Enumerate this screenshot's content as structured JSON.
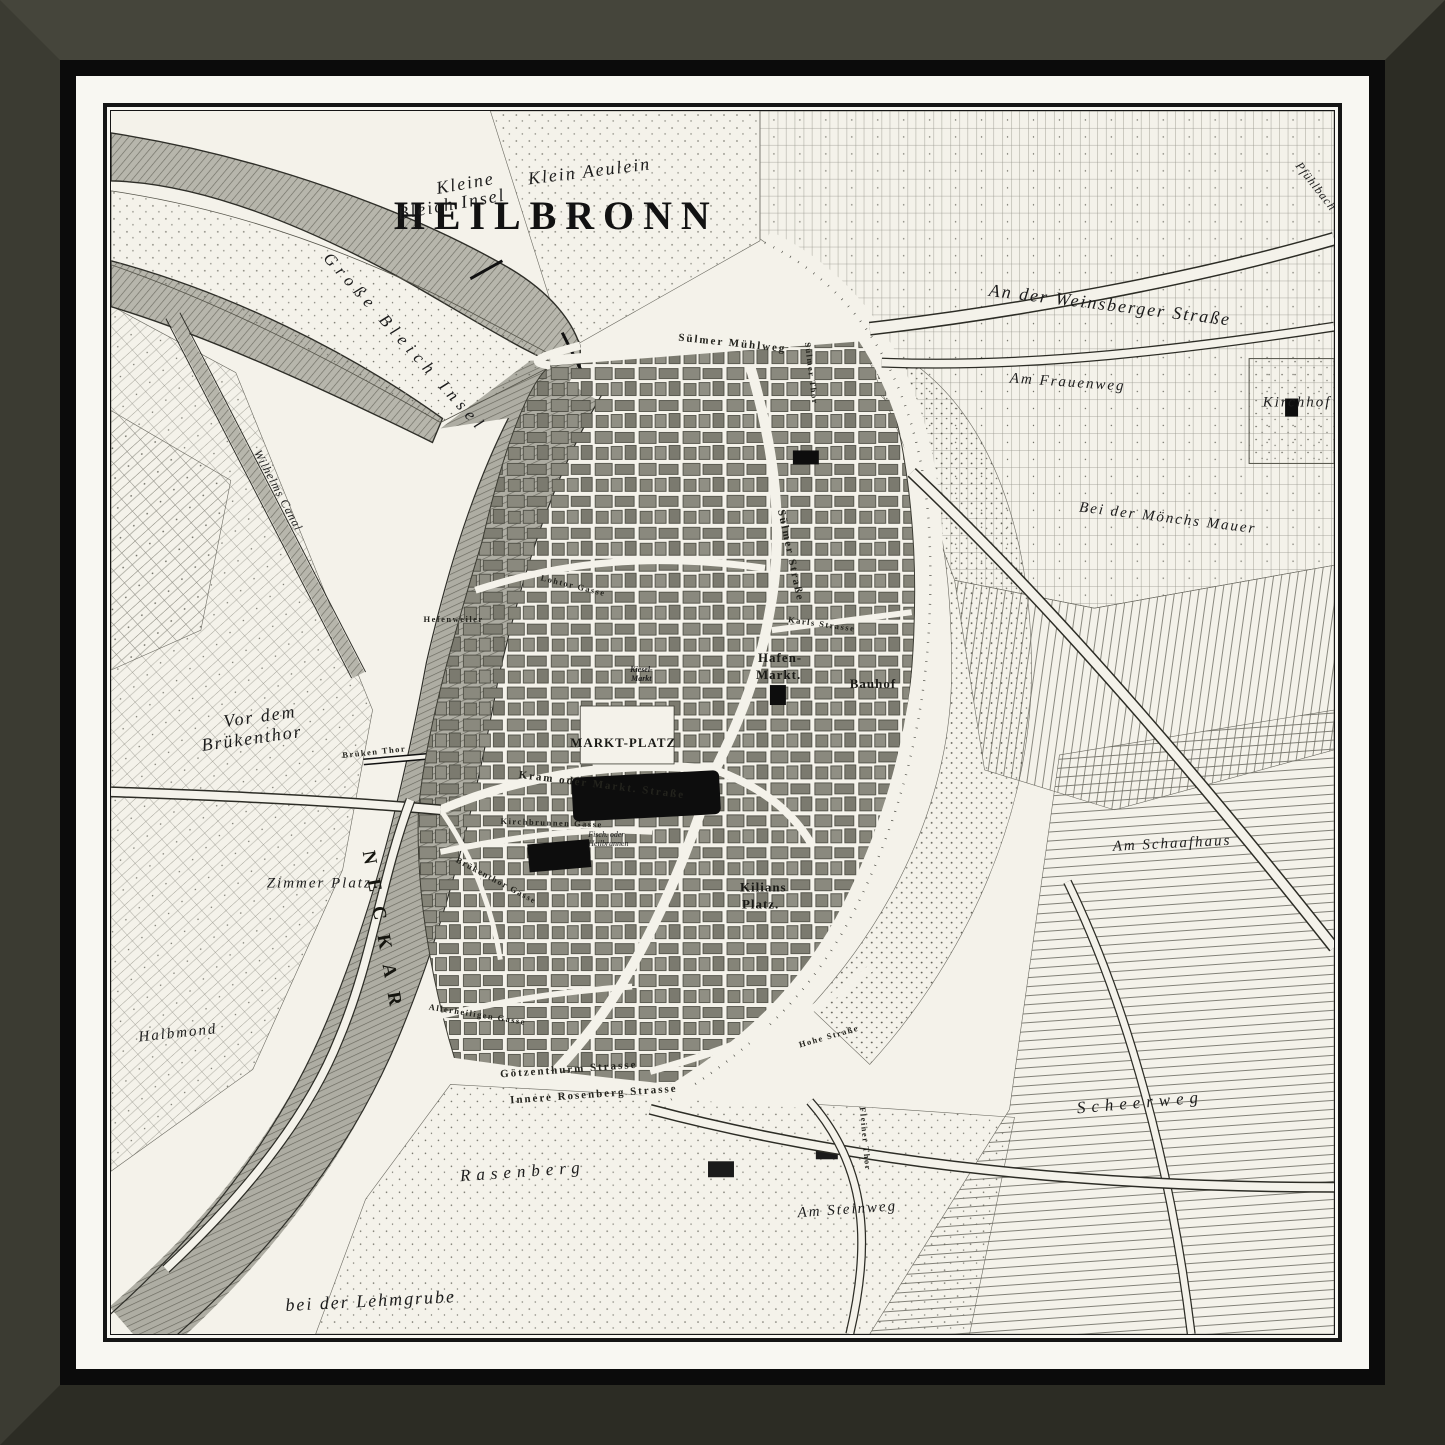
{
  "artwork": {
    "kind": "framed engraved city map",
    "title": "HEILBRONN"
  },
  "colors": {
    "frame": "#3b3b32",
    "frame-light": "#45453b",
    "frame-dark": "#2c2c24",
    "lip": "#0b0b0b",
    "mat": "#f8f7f2",
    "border": "#151515",
    "paper": "#f4f2ea",
    "ink": "#1c1c1c",
    "river": "#b5b4aa",
    "block": "#8a897e"
  },
  "map": {
    "title": "HEILBRONN",
    "labels": {
      "kleine_bleich_1": "Kleine",
      "kleine_bleich_2": "Bleich Insel",
      "klein_aeulein": "Klein Aeulein",
      "grosse_bleich_insel": "Große Bleich Insel",
      "pfuehlbach": "Pfühlbach",
      "weinsberger": "An der Weinsberger Straße",
      "frauenweg": "Am Frauenweg",
      "kirchhof": "Kirchhof",
      "moenchs_mauer": "Bei der Mönchs Mauer",
      "suelmer_muehlweg": "Sülmer Mühlweg",
      "suelmer_thor": "Sülmer Thor",
      "wilhelms_canal": "Wilhelms Canal",
      "hefenweiler": "Hefenweiler",
      "vor_dem_1": "Vor dem",
      "vor_dem_2": "Brükenthor",
      "brueken_thor": "Brüken Thor",
      "zimmer_platz": "Zimmer Platz",
      "neckar": "NECKAR",
      "halbmond": "Halbmond",
      "lehmgrube": "bei der Lehmgrube",
      "goetzenthurm": "Götzenthurm Strasse",
      "rosenberg_str": "Innere Rosenberg Strasse",
      "rasenberg": "Rasenberg",
      "fleiner_thor": "Fleiner Thor",
      "am_steinweg": "Am Steinweg",
      "scheerweg": "Scheerweg",
      "schaafhaus": "Am Schaafhaus",
      "markt_platz": "MARKT-PLATZ",
      "markt_strasse": "Kram oder Markt. Straße",
      "kirchbrunnen": "Kirchbrunnen Gasse",
      "heilbrunnen_1": "Fisch. oder",
      "heilbrunnen_2": "Heilbrunnen",
      "kilians_1": "Kilians",
      "kilians_2": "Platz.",
      "hafen_1": "Hafen-",
      "hafen_2": "Markt.",
      "kiesel_1": "Kiesel-",
      "kiesel_2": "Markt",
      "bauhof": "Bauhof",
      "karls_strasse": "Karls Strasse",
      "suelmer_strasse": "Sülmer Straße",
      "lohtor_gasse": "Lohtor Gasse",
      "bruekenthor_gasse": "Brükenthor Gasse",
      "allerheiligen": "Allerheiligen Gasse",
      "hohe_strasse": "Hohe Straße",
      "steinweg_small": "Am Steinweg"
    }
  }
}
